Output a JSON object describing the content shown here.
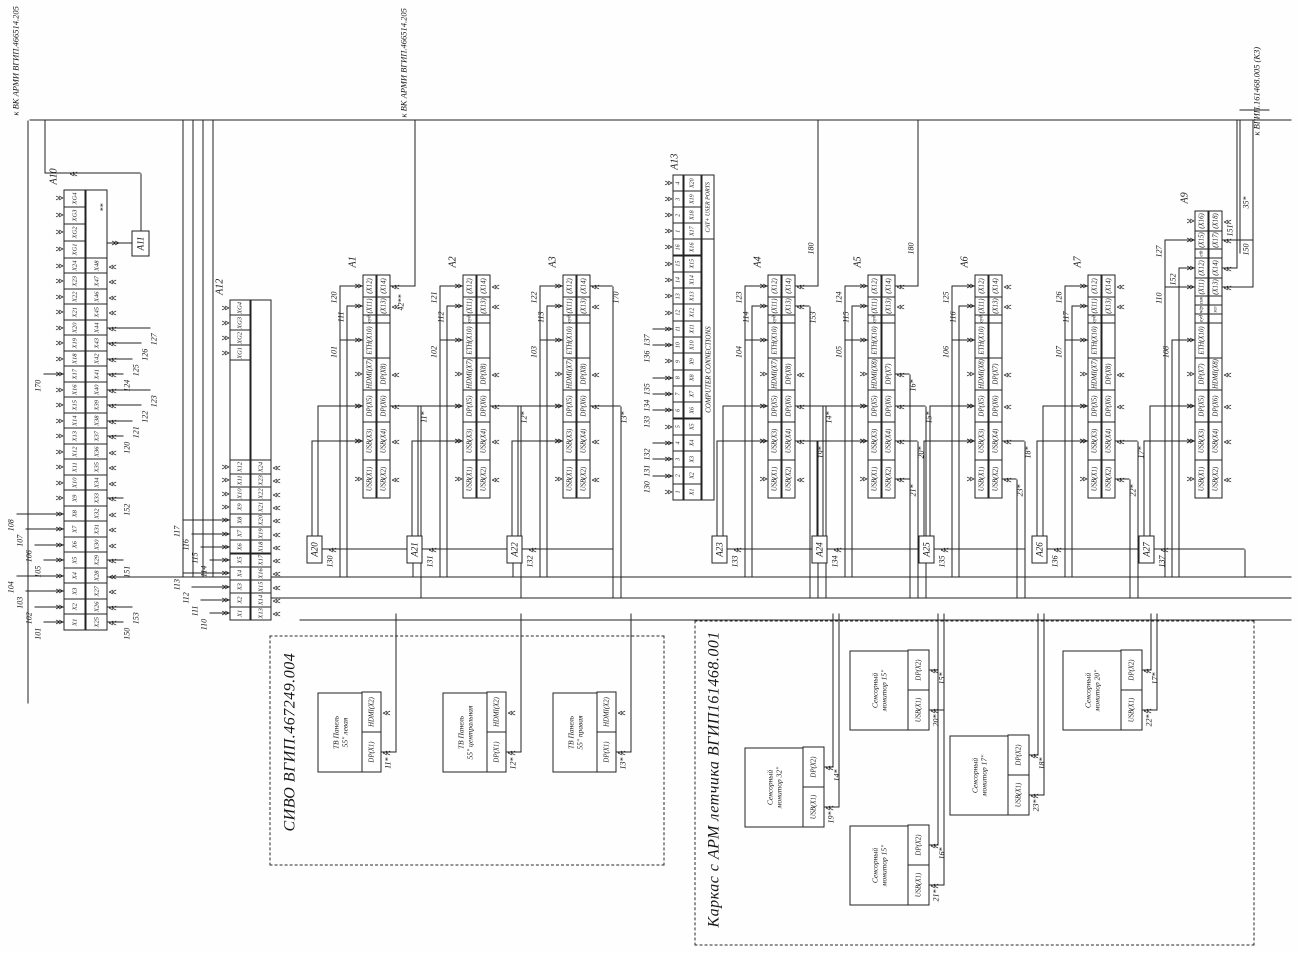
{
  "offpage": [
    {
      "text": "к ВК АРМИ ВГИП.466514.205"
    },
    {
      "text": "к ВК АРМИ ВГИП.466514.205"
    },
    {
      "text": "к ВГИП.161468.005 (К3)"
    }
  ],
  "a10": {
    "label": "А10",
    "x": 323,
    "y": 64,
    "rowh": 22,
    "cw": 15.5,
    "top_cells": [
      {
        "t": "X1",
        "wt": "101"
      },
      {
        "t": "X2",
        "wt": "102"
      },
      {
        "t": "X3",
        "wt": "103"
      },
      {
        "t": "X4",
        "wt": "104"
      },
      {
        "t": "X5",
        "wt": "105"
      },
      {
        "t": "X6",
        "wt": "106"
      },
      {
        "t": "X7",
        "wt": "107"
      },
      {
        "t": "X8",
        "wt": "108"
      },
      {
        "t": "X9"
      },
      {
        "t": "X10"
      },
      {
        "t": "X11"
      },
      {
        "t": "X12"
      },
      {
        "t": "X13"
      },
      {
        "t": "X14"
      },
      {
        "t": "X15"
      },
      {
        "t": "X16"
      },
      {
        "t": "X17",
        "wt": "170"
      },
      {
        "t": "X18"
      },
      {
        "t": "X19"
      },
      {
        "t": "X20"
      },
      {
        "t": "X21"
      },
      {
        "t": "X22"
      },
      {
        "t": "X23"
      },
      {
        "t": "X24"
      },
      {
        "t": "XG1",
        "w": 17
      },
      {
        "t": "XG2",
        "w": 17
      },
      {
        "t": "XG3",
        "w": 17
      },
      {
        "t": "XG4",
        "w": 17
      }
    ],
    "bottom_cells": [
      {
        "t": "X25",
        "wb": "150"
      },
      {
        "t": "X26",
        "wb": "153"
      },
      {
        "t": "X27"
      },
      {
        "t": "X28"
      },
      {
        "t": "X29",
        "wb": "151"
      },
      {
        "t": "X30"
      },
      {
        "t": "X31"
      },
      {
        "t": "X32"
      },
      {
        "t": "X33",
        "wb": "152"
      },
      {
        "t": "X34"
      },
      {
        "t": "X35"
      },
      {
        "t": "X36"
      },
      {
        "t": "X37",
        "wb": "120"
      },
      {
        "t": "X38",
        "wb": "121"
      },
      {
        "t": "X39",
        "wb": "122"
      },
      {
        "t": "X40",
        "wb": "123"
      },
      {
        "t": "X41",
        "wb": "124"
      },
      {
        "t": "X42",
        "wb": "125"
      },
      {
        "t": "X43",
        "wb": "126"
      },
      {
        "t": "X44",
        "wb": "127"
      },
      {
        "t": "X45"
      },
      {
        "t": "X46"
      },
      {
        "t": "X47"
      },
      {
        "t": "X48"
      },
      {
        "t": "",
        "w": 68
      }
    ]
  },
  "a11": {
    "label": "А11",
    "wire": "**"
  },
  "a12": {
    "label": "А12",
    "x": 333,
    "y": 230,
    "rowh": 21,
    "cw": 13.3,
    "top_cells": [
      {
        "t": "X1",
        "wt": "110"
      },
      {
        "t": "X2",
        "wt": "111"
      },
      {
        "t": "X3",
        "wt": "112"
      },
      {
        "t": "X4",
        "wt": "113"
      },
      {
        "t": "X5",
        "wt": "114"
      },
      {
        "t": "X6",
        "wt": "115"
      },
      {
        "t": "X7",
        "wt": "116"
      },
      {
        "t": "X8",
        "wt": "117"
      },
      {
        "t": "X9"
      },
      {
        "t": "X10"
      },
      {
        "t": "X11"
      },
      {
        "t": "X12"
      },
      {
        "t": "",
        "w": 100,
        "noarr": true
      },
      {
        "t": "XG1",
        "w": 15
      },
      {
        "t": "XG2",
        "w": 15
      },
      {
        "t": "XG3",
        "w": 15
      },
      {
        "t": "XG4",
        "w": 15
      }
    ],
    "bottom_cells": [
      {
        "t": "X13"
      },
      {
        "t": "X14"
      },
      {
        "t": "X15"
      },
      {
        "t": "X16"
      },
      {
        "t": "X17"
      },
      {
        "t": "X18"
      },
      {
        "t": "X19"
      },
      {
        "t": "X20"
      },
      {
        "t": "X21"
      },
      {
        "t": "X22"
      },
      {
        "t": "X23"
      },
      {
        "t": "X24"
      },
      {
        "t": "",
        "w": 160,
        "noarr": true
      }
    ]
  },
  "a13": {
    "label": "А13",
    "x": 453,
    "y": 673,
    "cells": [
      {
        "n": "1",
        "t": "X1"
      },
      {
        "n": "2",
        "t": "X2",
        "wt": "130"
      },
      {
        "n": "3",
        "t": "X3",
        "wt": "131"
      },
      {
        "n": "4",
        "t": "X4",
        "wt": "132"
      },
      {
        "n": "5",
        "t": "X5"
      },
      {
        "n": "6",
        "t": "X6",
        "wt": "133"
      },
      {
        "n": "7",
        "t": "X7",
        "wt": "134"
      },
      {
        "n": "8",
        "t": "X8",
        "wt": "135"
      },
      {
        "n": "9",
        "t": "X9"
      },
      {
        "n": "10",
        "t": "X10",
        "wt": "136"
      },
      {
        "n": "11",
        "t": "X11",
        "wt": "137"
      },
      {
        "n": "12",
        "t": "X12"
      },
      {
        "n": "13",
        "t": "X13"
      },
      {
        "n": "14",
        "t": "X14"
      },
      {
        "n": "15",
        "t": "X15"
      },
      {
        "n": "16",
        "t": "X16"
      },
      {
        "n": "1",
        "t": "X17",
        "cat": true
      },
      {
        "n": "2",
        "t": "X18",
        "cat": true
      },
      {
        "n": "3",
        "t": "X19",
        "cat": true
      },
      {
        "n": "4",
        "t": "X20",
        "cat": true
      }
    ],
    "groups": [
      {
        "label": "COMPUTER CONNECTIONS"
      },
      {
        "label": "CAT+ USER PORTS"
      }
    ]
  },
  "computers": [
    {
      "label": "А1",
      "y": 363,
      "ext": "А20",
      "ext_wire": "130",
      "cells": [
        {
          "a": "USB(X1)",
          "b": "USB(X2)",
          "w": 38
        },
        {
          "a": "USB(X3)",
          "b": "USB(X4)",
          "w": 38,
          "in": true
        },
        {
          "a": "DP(X5)",
          "b": "DP(X6)",
          "w": 32,
          "in": true,
          "wb": "11*"
        },
        {
          "a": "HDMI(X7)",
          "b": "DP(X8)",
          "w": 32
        },
        {
          "a": "ETH(X10)",
          "b": "",
          "w": 35,
          "wt": "101"
        },
        {
          "a": "ауд",
          "b": "",
          "w": 8,
          "sm": true
        },
        {
          "a": "(X11)",
          "b": "(X13)",
          "w": 18,
          "wt": "111"
        },
        {
          "a": "(X12)",
          "b": "(X14)",
          "w": 22,
          "wt": "120",
          "wb": "42**"
        }
      ]
    },
    {
      "label": "А2",
      "y": 463,
      "ext": "А21",
      "ext_wire": "131",
      "cells": [
        {
          "a": "USB(X1)",
          "b": "USB(X2)",
          "w": 38
        },
        {
          "a": "USB(X3)",
          "b": "USB(X4)",
          "w": 38,
          "in": true
        },
        {
          "a": "DP(X5)",
          "b": "DP(X6)",
          "w": 32,
          "in": true,
          "wb": "12*"
        },
        {
          "a": "HDMI(X7)",
          "b": "DP(X8)",
          "w": 32
        },
        {
          "a": "ETH(X10)",
          "b": "",
          "w": 35,
          "wt": "102"
        },
        {
          "a": "ауд",
          "b": "",
          "w": 8,
          "sm": true
        },
        {
          "a": "(X11)",
          "b": "(X13)",
          "w": 18,
          "wt": "112"
        },
        {
          "a": "(X12)",
          "b": "(X14)",
          "w": 22,
          "wt": "121"
        }
      ]
    },
    {
      "label": "А3",
      "y": 563,
      "ext": "А22",
      "ext_wire": "132",
      "cells": [
        {
          "a": "USB(X1)",
          "b": "USB(X2)",
          "w": 38
        },
        {
          "a": "USB(X3)",
          "b": "USB(X4)",
          "w": 38,
          "in": true
        },
        {
          "a": "DP(X5)",
          "b": "DP(X6)",
          "w": 32,
          "in": true,
          "wb": "13*"
        },
        {
          "a": "HDMI(X7)",
          "b": "DP(X8)",
          "w": 32
        },
        {
          "a": "ETH(X10)",
          "b": "",
          "w": 35,
          "wt": "103"
        },
        {
          "a": "ауд",
          "b": "",
          "w": 8,
          "sm": true
        },
        {
          "a": "(X11)",
          "b": "(X13)",
          "w": 18,
          "wt": "113"
        },
        {
          "a": "(X12)",
          "b": "(X14)",
          "w": 22,
          "wt": "122",
          "wb": "170"
        }
      ]
    },
    {
      "label": "А4",
      "y": 768,
      "ext": "А23",
      "ext_wire": "133",
      "cells": [
        {
          "a": "USB(X1)",
          "b": "USB(X2)",
          "w": 38
        },
        {
          "a": "USB(X3)",
          "b": "USB(X4)",
          "w": 38,
          "in": true,
          "wb": "19*"
        },
        {
          "a": "DP(X5)",
          "b": "DP(X6)",
          "w": 32,
          "in": true,
          "wb": "14*"
        },
        {
          "a": "HDMI(X7)",
          "b": "DP(X8)",
          "w": 32
        },
        {
          "a": "ETH(X10)",
          "b": "",
          "w": 35,
          "wt": "104"
        },
        {
          "a": "ауд",
          "b": "",
          "w": 8,
          "sm": true
        },
        {
          "a": "(X11)",
          "b": "(X13)",
          "w": 18,
          "wt": "114",
          "wb": "153"
        },
        {
          "a": "(X12)",
          "b": "(X14)",
          "w": 22,
          "wt": "123",
          "wb": "180"
        }
      ]
    },
    {
      "label": "А5",
      "y": 868,
      "ext": "А24",
      "ext_wire": "134",
      "cells": [
        {
          "a": "USB(X1)",
          "b": "USB(X2)",
          "w": 38,
          "wb": "21*"
        },
        {
          "a": "USB(X3)",
          "b": "USB(X4)",
          "w": 38,
          "in": true,
          "wb": "20*"
        },
        {
          "a": "DP(X5)",
          "b": "DP(X6)",
          "w": 32,
          "in": true,
          "wb": "15*"
        },
        {
          "a": "HDMI(X8)",
          "b": "DP(X7)",
          "w": 32,
          "wb": "16*"
        },
        {
          "a": "ETH(X10)",
          "b": "",
          "w": 35,
          "wt": "105"
        },
        {
          "a": "ауд",
          "b": "",
          "w": 8,
          "sm": true
        },
        {
          "a": "(X11)",
          "b": "(X13)",
          "w": 18,
          "wt": "115"
        },
        {
          "a": "(X12)",
          "b": "(X14)",
          "w": 22,
          "wt": "124",
          "wb": "180"
        }
      ]
    },
    {
      "label": "А6",
      "y": 975,
      "ext": "А25",
      "ext_wire": "135",
      "cells": [
        {
          "a": "USB(X1)",
          "b": "USB(X2)",
          "w": 38,
          "wb": "23*"
        },
        {
          "a": "USB(X3)",
          "b": "USB(X4)",
          "w": 38,
          "in": true,
          "wb": "18*"
        },
        {
          "a": "DP(X5)",
          "b": "DP(X6)",
          "w": 32,
          "in": true
        },
        {
          "a": "HDMI(X8)",
          "b": "DP(X7)",
          "w": 32
        },
        {
          "a": "ETH(X10)",
          "b": "",
          "w": 35,
          "wt": "106"
        },
        {
          "a": "ауд",
          "b": "",
          "w": 8,
          "sm": true
        },
        {
          "a": "(X11)",
          "b": "(X13)",
          "w": 18,
          "wt": "116"
        },
        {
          "a": "(X12)",
          "b": "(X14)",
          "w": 22,
          "wt": "125"
        }
      ]
    },
    {
      "label": "А7",
      "y": 1088,
      "ext": "А26",
      "ext_wire": "136",
      "cells": [
        {
          "a": "USB(X1)",
          "b": "USB(X2)",
          "w": 38,
          "wb": "22*"
        },
        {
          "a": "USB(X3)",
          "b": "USB(X4)",
          "w": 38,
          "in": true,
          "wb": "17*"
        },
        {
          "a": "DP(X5)",
          "b": "DP(X6)",
          "w": 32,
          "in": true
        },
        {
          "a": "HDMI(X7)",
          "b": "DP(X8)",
          "w": 32
        },
        {
          "a": "ETH(X10)",
          "b": "",
          "w": 35,
          "wt": "107"
        },
        {
          "a": "ауд",
          "b": "",
          "w": 8,
          "sm": true
        },
        {
          "a": "(X11)",
          "b": "(X13)",
          "w": 18,
          "wt": "117"
        },
        {
          "a": "(X12)",
          "b": "(X14)",
          "w": 22,
          "wt": "126"
        }
      ]
    },
    {
      "label": "А9",
      "y": 1195,
      "ext": "А27",
      "ext_wire": "137",
      "cells": [
        {
          "a": "USB(X1)",
          "b": "USB(X2)",
          "w": 38
        },
        {
          "a": "USB(X3)",
          "b": "USB(X4)",
          "w": 38,
          "in": true
        },
        {
          "a": "DP(X5)",
          "b": "DP(X6)",
          "w": 32,
          "in": true
        },
        {
          "a": "DP(X7)",
          "b": "HDMI(X8)",
          "w": 32
        },
        {
          "a": "ETH(X10)",
          "b": "",
          "w": 35,
          "wt": "108"
        },
        {
          "a": "ауд",
          "b": "",
          "w": 9,
          "sm": true
        },
        {
          "a": "чёр",
          "b": "зел",
          "w": 9,
          "sm": true
        },
        {
          "a": "син",
          "b": "",
          "w": 9,
          "sm": true
        },
        {
          "a": "(X11)",
          "b": "(X13)",
          "w": 18,
          "wt": "110",
          "wb": "150"
        },
        {
          "a": "(X12)",
          "b": "(X14)",
          "w": 20,
          "wt": "152",
          "wb": "151"
        },
        {
          "a": "eth",
          "b": "",
          "w": 9,
          "sm": true
        },
        {
          "a": "(X15)",
          "b": "(X17)",
          "w": 18,
          "wt": "127",
          "wb": "35*"
        },
        {
          "a": "(X16)",
          "b": "(X18)",
          "w": 20
        }
      ]
    }
  ],
  "sivo": {
    "title": "СИВО ВГИП.467249.004",
    "panels": [
      {
        "l1": "ТВ Панель",
        "l2": "55\" левая",
        "p1": "DP(X1)",
        "p2": "HDMI(X2)",
        "wire": "11*",
        "y": 318
      },
      {
        "l1": "ТВ Панель",
        "l2": "55\" центральная",
        "p1": "DP(X1)",
        "p2": "HDMI(X2)",
        "wire": "12*",
        "y": 443
      },
      {
        "l1": "ТВ Панель",
        "l2": "55\" правая",
        "p1": "DP(X1)",
        "p2": "HDMI(X2)",
        "wire": "13*",
        "y": 553
      }
    ]
  },
  "karkas": {
    "title": "Каркас с АРМ летчика ВГИП161468.001",
    "monitors": [
      {
        "l1": "Сенсорный",
        "l2": "монитор 32\"",
        "p1": "USB(X1)",
        "p2": "DP(X2)",
        "usb_wire": "19*",
        "dp_wire": "14*",
        "x": 126,
        "y": 745
      },
      {
        "l1": "Сенсорный",
        "l2": "монитор 15\"",
        "p1": "USB(X1)",
        "p2": "DP(X2)",
        "usb_wire": "20*",
        "dp_wire": "15*",
        "x": 223,
        "y": 850
      },
      {
        "l1": "Сенсорный",
        "l2": "монитор 15\"",
        "p1": "USB(X1)",
        "p2": "DP(X2)",
        "usb_wire": "21*",
        "dp_wire": "16*",
        "x": 48,
        "y": 850
      },
      {
        "l1": "Сенсорный",
        "l2": "монитор 17\"",
        "p1": "USB(X1)",
        "p2": "DP(X2)",
        "usb_wire": "23*",
        "dp_wire": "18*",
        "x": 138,
        "y": 950
      },
      {
        "l1": "Сенсорный",
        "l2": "монитор 20\"",
        "p1": "USB(X1)",
        "p2": "DP(X2)",
        "usb_wire": "22*",
        "dp_wire": "17*",
        "x": 223,
        "y": 1063
      }
    ]
  },
  "wire_42": "42**",
  "lines": [
    [
      "v",
      833,
      30,
      1262
    ],
    [
      "h",
      250,
      28,
      583
    ],
    [
      "h",
      780,
      45,
      53
    ],
    [
      "v",
      780,
      45,
      96
    ],
    [
      "h",
      723,
      141,
      57
    ],
    [
      "v",
      376,
      100,
      1192
    ],
    [
      "v",
      355,
      268,
      1024
    ],
    [
      "v",
      333,
      300,
      992
    ],
    [
      "h",
      376,
      183,
      457
    ],
    [
      "h",
      376,
      193,
      457
    ],
    [
      "h",
      376,
      203,
      457
    ],
    [
      "h",
      376,
      213,
      457
    ],
    [
      "h",
      667,
      415,
      166
    ],
    [
      "h",
      201,
      396,
      139
    ],
    [
      "h",
      201,
      521,
      139
    ],
    [
      "h",
      201,
      631,
      139
    ],
    [
      "h",
      146,
      839,
      194
    ],
    [
      "h",
      186,
      833,
      154
    ],
    [
      "h",
      243,
      944,
      97
    ],
    [
      "h",
      283,
      938,
      57
    ],
    [
      "h",
      68,
      944,
      272
    ],
    [
      "h",
      108,
      938,
      232
    ],
    [
      "h",
      158,
      1044,
      182
    ],
    [
      "h",
      198,
      1038,
      142
    ],
    [
      "h",
      243,
      1157,
      97
    ],
    [
      "h",
      283,
      1151,
      57
    ],
    [
      "h",
      700,
      1240,
      133
    ],
    [
      "v",
      843,
      1240,
      30
    ]
  ]
}
